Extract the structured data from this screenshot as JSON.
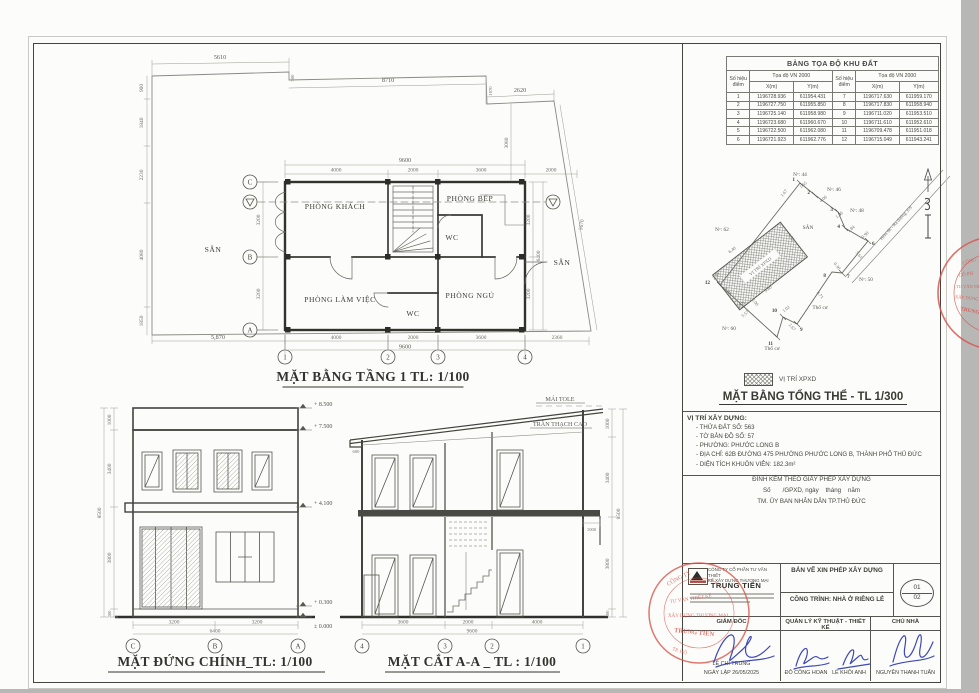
{
  "coord": {
    "title": "BẢNG TỌA ĐỘ KHU ĐẤT",
    "point_col": "Số hiệu điểm",
    "group_col": "Tọa độ VN 2000",
    "x_col": "X(m)",
    "y_col": "Y(m)",
    "rows": [
      [
        "1",
        "1196728.936",
        "611954.431",
        "7",
        "1196717.630",
        "611959.170"
      ],
      [
        "2",
        "1196727.750",
        "611955.850",
        "8",
        "1196717.830",
        "611958.940"
      ],
      [
        "3",
        "1196725.140",
        "611958.980",
        "9",
        "1196711.020",
        "611953.510"
      ],
      [
        "4",
        "1196723.680",
        "611960.670",
        "10",
        "1196711.610",
        "611952.610"
      ],
      [
        "5",
        "1196722.500",
        "611962.080",
        "11",
        "1196709.478",
        "611951.018"
      ],
      [
        "6",
        "1196721.923",
        "611962.776",
        "12",
        "1196715.049",
        "611943.241"
      ]
    ]
  },
  "site": {
    "title": "MẶT BẰNG TỔNG THỂ - TL 1/300",
    "legend": "VỊ TRÍ XPXD",
    "hatch_label": "VỊ TRÍ XPXD",
    "road": "Hẻm 96 - Ra đường 359",
    "san_top": "SÂN",
    "san_small": "SÂN",
    "thocu": [
      "Thổ cư",
      "Thổ cư"
    ],
    "neighbors": [
      "Nᵒ: 44",
      "Nᵒ: 46",
      "Nᵒ: 48",
      "Nᵒ: 50",
      "Nᵒ: 60",
      "Nᵒ: 62"
    ],
    "points": [
      "1",
      "2",
      "3",
      "4",
      "6",
      "7",
      "8",
      "9",
      "10",
      "11",
      "12"
    ],
    "edges": [
      "1.65",
      "4.06",
      "1.29",
      "1.84",
      "0.90",
      "5.61",
      "0.30",
      "8.71",
      "1.02",
      "2.67",
      "5.57",
      "2.36",
      "1.67"
    ],
    "inner": [
      "9.50",
      "6.40",
      "9.60",
      "6.40",
      "2.00"
    ]
  },
  "loc": {
    "heading": "VỊ TRÍ XÂY DỰNG:",
    "items": [
      "- THỬA ĐẤT SỐ:  563",
      "- TỜ BẢN ĐỒ SỐ:  57",
      "- PHƯỜNG:  PHƯỚC LONG B",
      "- ĐỊA CHỈ:  62B ĐƯỜNG 475 PHƯỜNG PHƯỚC LONG B, THÀNH PHỐ THỦ ĐỨC",
      "- DIỆN TÍCH KHUÔN VIÊN:  182.3m²"
    ]
  },
  "permit": {
    "l1": "ĐÍNH KÈM THEO GIẤY PHÉP XÂY DỰNG",
    "l2": "Số       /GPXD, ngày    tháng    năm",
    "l3": "TM. ỦY BAN NHÂN DÂN TP.THỦ ĐỨC"
  },
  "tb": {
    "company1": "CÔNG TY CỔ PHẦN TƯ VẤN THIẾT",
    "company2": "KẾ XÂY DỰNG THƯƠNG MẠI",
    "company_name": "TRUNG TIẾN",
    "doc": "BẢN VẼ XIN PHÉP XÂY DỰNG",
    "project": "CÔNG TRÌNH: NHÀ Ở RIÊNG LẺ",
    "sheet_no": "01",
    "sheet_total": "02",
    "role1": "GIÁM ĐỐC",
    "role2": "QUẢN LÝ KỸ THUẬT - THIẾT KẾ",
    "role3": "CHỦ NHÀ",
    "name1": "LÊ CHÍ TRUNG",
    "date": "NGÀY LẬP 26/05/2025",
    "name2": "ĐỖ CÔNG HOAN",
    "name3": "LÊ KHÔI ANH",
    "name4": "NGUYỄN THANH TUẤN"
  },
  "fp": {
    "title": "MẶT BẰNG TẦNG 1 TL: 1/100",
    "rooms": {
      "khach": "PHÒNG KHÁCH",
      "bep": "PHÒNG BẾP",
      "wc1": "WC",
      "lamviec": "PHÒNG LÀM VIỆC",
      "ngu": "PHÒNG NGỦ",
      "wc2": "WC",
      "san_left": "SÂN",
      "san_right": "SÂN"
    },
    "grid_rows": [
      "C",
      "B",
      "A"
    ],
    "grid_cols": [
      "1",
      "2",
      "3",
      "4"
    ],
    "dims": {
      "site_top": [
        "5610",
        "8710",
        "2620",
        "300",
        "1070",
        "3080",
        "5670"
      ],
      "site_left": [
        "900",
        "1840",
        "2230",
        "4080",
        "1850"
      ],
      "site_bottom": "5,870",
      "top": [
        "9600",
        "4000",
        "2000",
        "3600",
        "2000"
      ],
      "bottom": [
        "4000",
        "2000",
        "3600",
        "9600",
        "2360"
      ],
      "left": [
        "3200",
        "3200"
      ],
      "right": [
        "3200",
        "3200",
        "6400"
      ]
    }
  },
  "el": {
    "title": "MẶT ĐỨNG CHÍNH_TL: 1/100",
    "levels": [
      "+ 8.500",
      "+ 7.500",
      "+ 4.100",
      "+ 0.300",
      "± 0.000"
    ],
    "chain": [
      "1000",
      "3400",
      "3800",
      "300"
    ],
    "total": "8500",
    "bottom": [
      "3200",
      "3200"
    ],
    "btotal": "6400",
    "grid": [
      "C",
      "B",
      "A"
    ]
  },
  "sec": {
    "title": "MẶT CẮT A-A _ TL : 1/100",
    "roof": "MÁI TOLE",
    "ceiling": "TRẦN THẠCH CAO",
    "eave": "600",
    "balc": "1000",
    "chain": [
      "1000",
      "3400",
      "3800",
      "300"
    ],
    "total": "8500",
    "bottom": [
      "3600",
      "2000",
      "4000"
    ],
    "btotal": "9600",
    "grid": [
      "4",
      "3",
      "2",
      "1"
    ]
  },
  "stamps": {
    "side": [
      "CÔNG",
      "CỔ PH",
      "TƯ VẤN TH",
      "XÂY DỰNG TH",
      "TRUNG"
    ],
    "block": [
      "CÔNG TY",
      "TƯ VẤN THIẾT KẾ",
      "XÂY DỰNG THƯƠNG MẠI",
      "TRUNG TIẾN",
      "TP. HỒ"
    ]
  }
}
